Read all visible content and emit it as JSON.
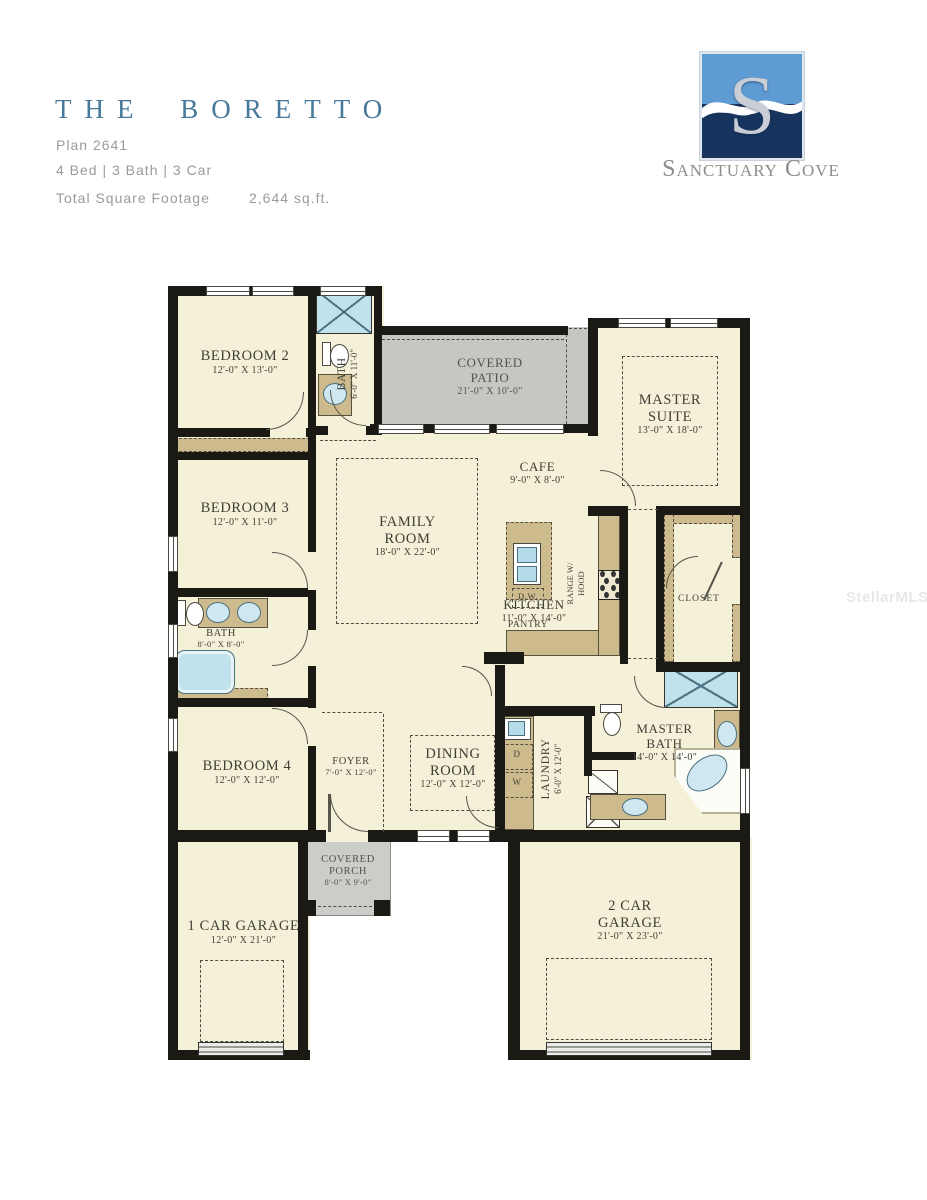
{
  "header": {
    "title": "THE BORETTO",
    "plan": "Plan 2641",
    "specs": "4 Bed | 3 Bath | 3 Car",
    "sqft_label": "Total Square Footage",
    "sqft_value": "2,644 sq.ft."
  },
  "logo": {
    "monogram": "S",
    "brand": "Sanctuary Cove"
  },
  "watermark": "StellarMLS",
  "rooms": {
    "bedroom2": {
      "line1": "BEDROOM 2",
      "dims": "12'-0\" X 13'-0\""
    },
    "bath3": {
      "line1": "BATH",
      "dims": "6'-0\" X 11'-0\""
    },
    "covered_patio": {
      "line1": "COVERED",
      "line2": "PATIO",
      "dims": "21'-0\" X 10'-0\""
    },
    "master_suite": {
      "line1": "MASTER",
      "line2": "SUITE",
      "dims": "13'-0\" X 18'-0\""
    },
    "bedroom3": {
      "line1": "BEDROOM 3",
      "dims": "12'-0\" X 11'-0\""
    },
    "family_room": {
      "line1": "FAMILY",
      "line2": "ROOM",
      "dims": "18'-0\" X 22'-0\""
    },
    "cafe": {
      "line1": "CAFE",
      "dims": "9'-0\" X 8'-0\""
    },
    "kitchen": {
      "line1": "KITCHEN",
      "dims": "11'-0\" X 14'-0\""
    },
    "bath2": {
      "line1": "BATH",
      "dims": "8'-0\" X 8'-0\""
    },
    "bedroom4": {
      "line1": "BEDROOM 4",
      "dims": "12'-0\" X 12'-0\""
    },
    "foyer": {
      "line1": "FOYER",
      "dims": "7'-0\" X 12'-0\""
    },
    "dining_room": {
      "line1": "DINING",
      "line2": "ROOM",
      "dims": "12'-0\" X 12'-0\""
    },
    "laundry": {
      "line1": "LAUNDRY",
      "dims": "6'-0\" X 12'-0\""
    },
    "master_bath": {
      "line1": "MASTER",
      "line2": "BATH",
      "dims": "14'-0\" X 14'-0\""
    },
    "closet": {
      "line1": "CLOSET"
    },
    "covered_porch": {
      "line1": "COVERED",
      "line2": "PORCH",
      "dims": "8'-0\" X 9'-0\""
    },
    "garage1": {
      "line1": "1 CAR GARAGE",
      "dims": "12'-0\" X 21'-0\""
    },
    "garage2": {
      "line1": "2 CAR",
      "line2": "GARAGE",
      "dims": "21'-0\" X 23'-0\""
    },
    "pantry": {
      "line1": "PANTRY"
    }
  },
  "fixtures": {
    "dishwasher": "D.W.",
    "range_line1": "RANGE W/",
    "range_line2": "HOOD",
    "dryer": "D",
    "washer": "W"
  }
}
